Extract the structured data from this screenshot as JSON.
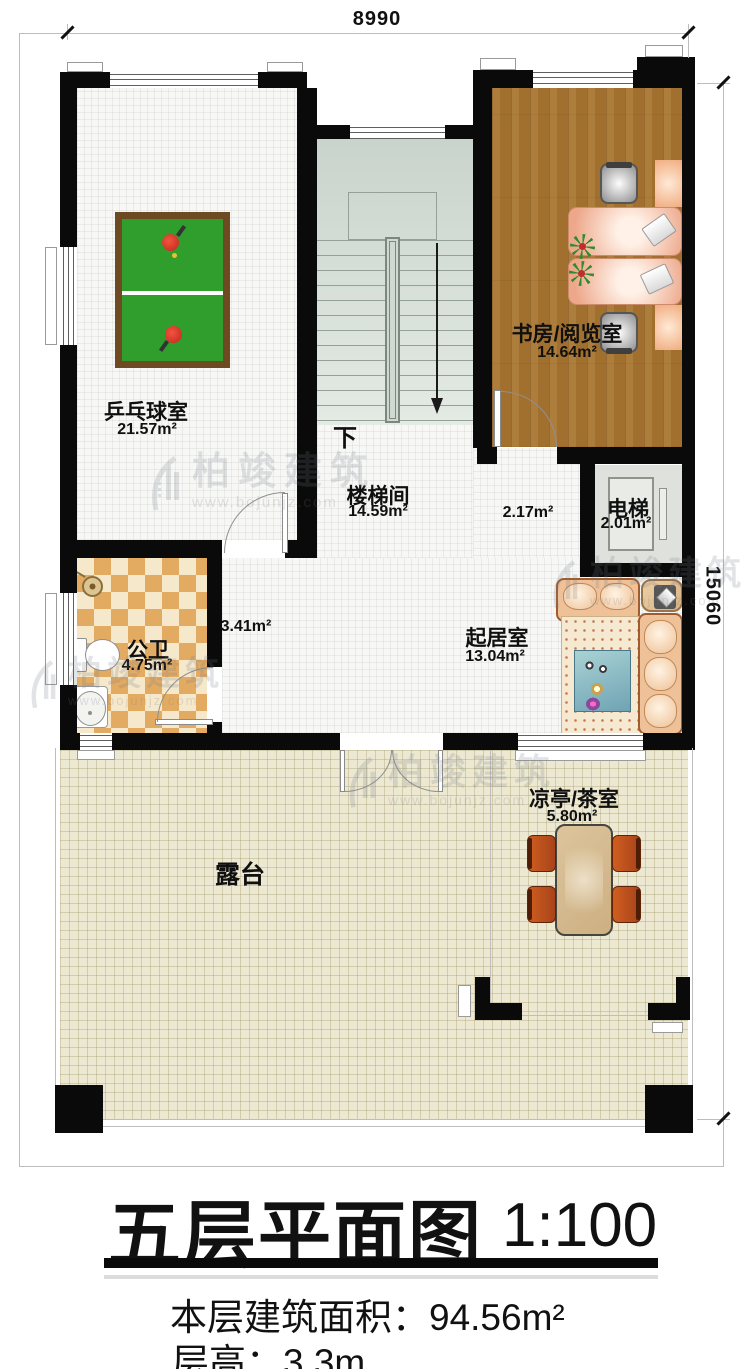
{
  "plan": {
    "scale_note": "1:100",
    "floor_label": "五层平面图"
  },
  "dimensions": {
    "top": "8990",
    "right": "15060"
  },
  "rooms": {
    "pingpong": {
      "name": "乒乓球室",
      "area": "21.57m²"
    },
    "study": {
      "name": "书房/阅览室",
      "area": "14.64m²"
    },
    "stairwell": {
      "name": "楼梯间",
      "area": "14.59m²"
    },
    "elevator": {
      "name": "电梯",
      "area": "2.01m²"
    },
    "bathroom": {
      "name": "公卫",
      "area": "4.75m²"
    },
    "living": {
      "name": "起居室",
      "area": "13.04m²"
    },
    "pavilion": {
      "name": "凉亭/茶室",
      "area": "5.80m²"
    },
    "terrace": {
      "name": "露台"
    }
  },
  "extra_areas": {
    "hall_left": "3.41m²",
    "hall_right": "2.17m²"
  },
  "stairs": {
    "down_label": "下"
  },
  "title_block": {
    "title": "五层平面图",
    "scale": "1:100",
    "area_line": "本层建筑面积：94.56m²",
    "floor_height_line": "层高：3.3m"
  },
  "watermark": {
    "brand": "柏竣建筑",
    "url": "www.bojunjz.com"
  },
  "colors": {
    "wall": "#0a0a0a",
    "wood_floor": "#a2702e",
    "terrace_floor": "#ece8d2",
    "checker_dark": "#e3ab62",
    "checker_light": "#f6e8cb",
    "pingpong_green": "#2f9e2c",
    "stair_floor": "#d6dfd8",
    "sofa_tan": "#eec199",
    "chair_orange": "#cf5d20"
  }
}
